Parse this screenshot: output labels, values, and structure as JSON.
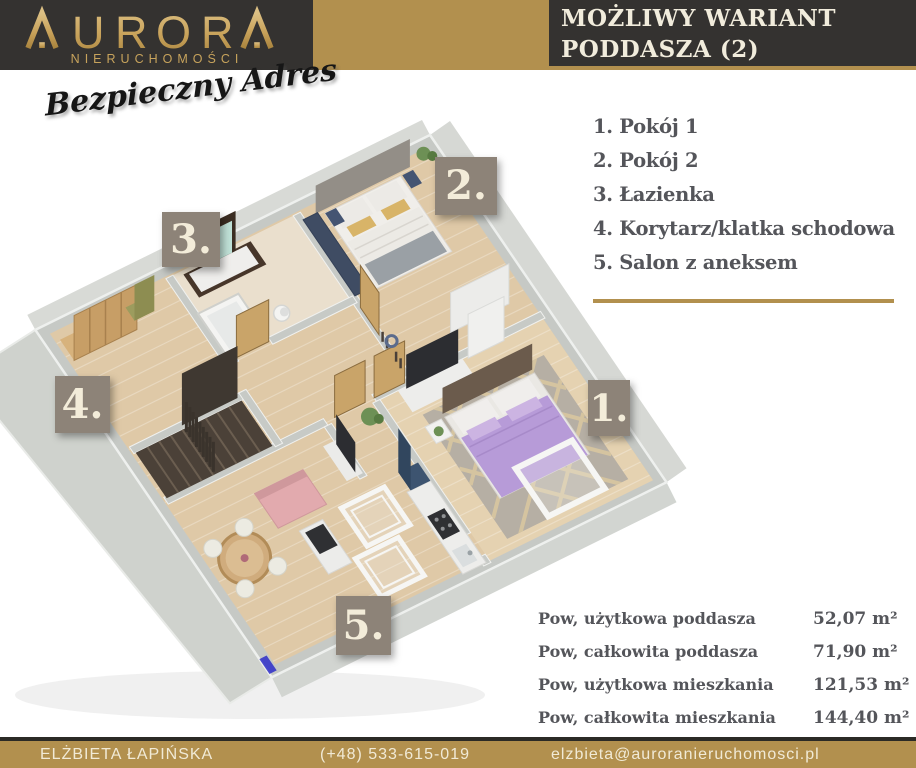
{
  "brand": {
    "name": "AURORA",
    "subtitle": "NIERUCHOMOŚCI",
    "tagline": "Bezpieczny Adres"
  },
  "header": {
    "title_line1": "MOŻLIWY WARIANT",
    "title_line2": "PODDASZA (2)"
  },
  "legend": {
    "items": [
      {
        "label": "1. Pokój 1"
      },
      {
        "label": "2. Pokój 2"
      },
      {
        "label": "3. Łazienka"
      },
      {
        "label": "4. Korytarz/klatka schodowa"
      },
      {
        "label": "5. Salon z aneksem"
      }
    ]
  },
  "plan": {
    "labels": [
      {
        "room": "Pokój 1",
        "text": "1."
      },
      {
        "room": "Pokój 2",
        "text": "2."
      },
      {
        "room": "Łazienka",
        "text": "3."
      },
      {
        "room": "Korytarz/klatka schodowa",
        "text": "4."
      },
      {
        "room": "Salon z aneksem",
        "text": "5."
      }
    ]
  },
  "measurements": {
    "rows": [
      {
        "label": "Pow, użytkowa poddasza",
        "value": "52,07 m²"
      },
      {
        "label": "Pow, całkowita poddasza",
        "value": "71,90 m²"
      },
      {
        "label": "Pow, użytkowa mieszkania",
        "value": "121,53 m²"
      },
      {
        "label": "Pow, całkowita mieszkania",
        "value": "144,40 m²"
      }
    ]
  },
  "footer": {
    "agent": "ELŻBIETA ŁAPIŃSKA",
    "phone": "(+48) 533-615-019",
    "email": "elzbieta@auroranieruchomosci.pl"
  },
  "colors": {
    "gold": "#b2904e",
    "dark": "#343230",
    "cream": "#f2ecd9",
    "label_taupe": "#8d8378",
    "text_gray": "#54555a"
  }
}
